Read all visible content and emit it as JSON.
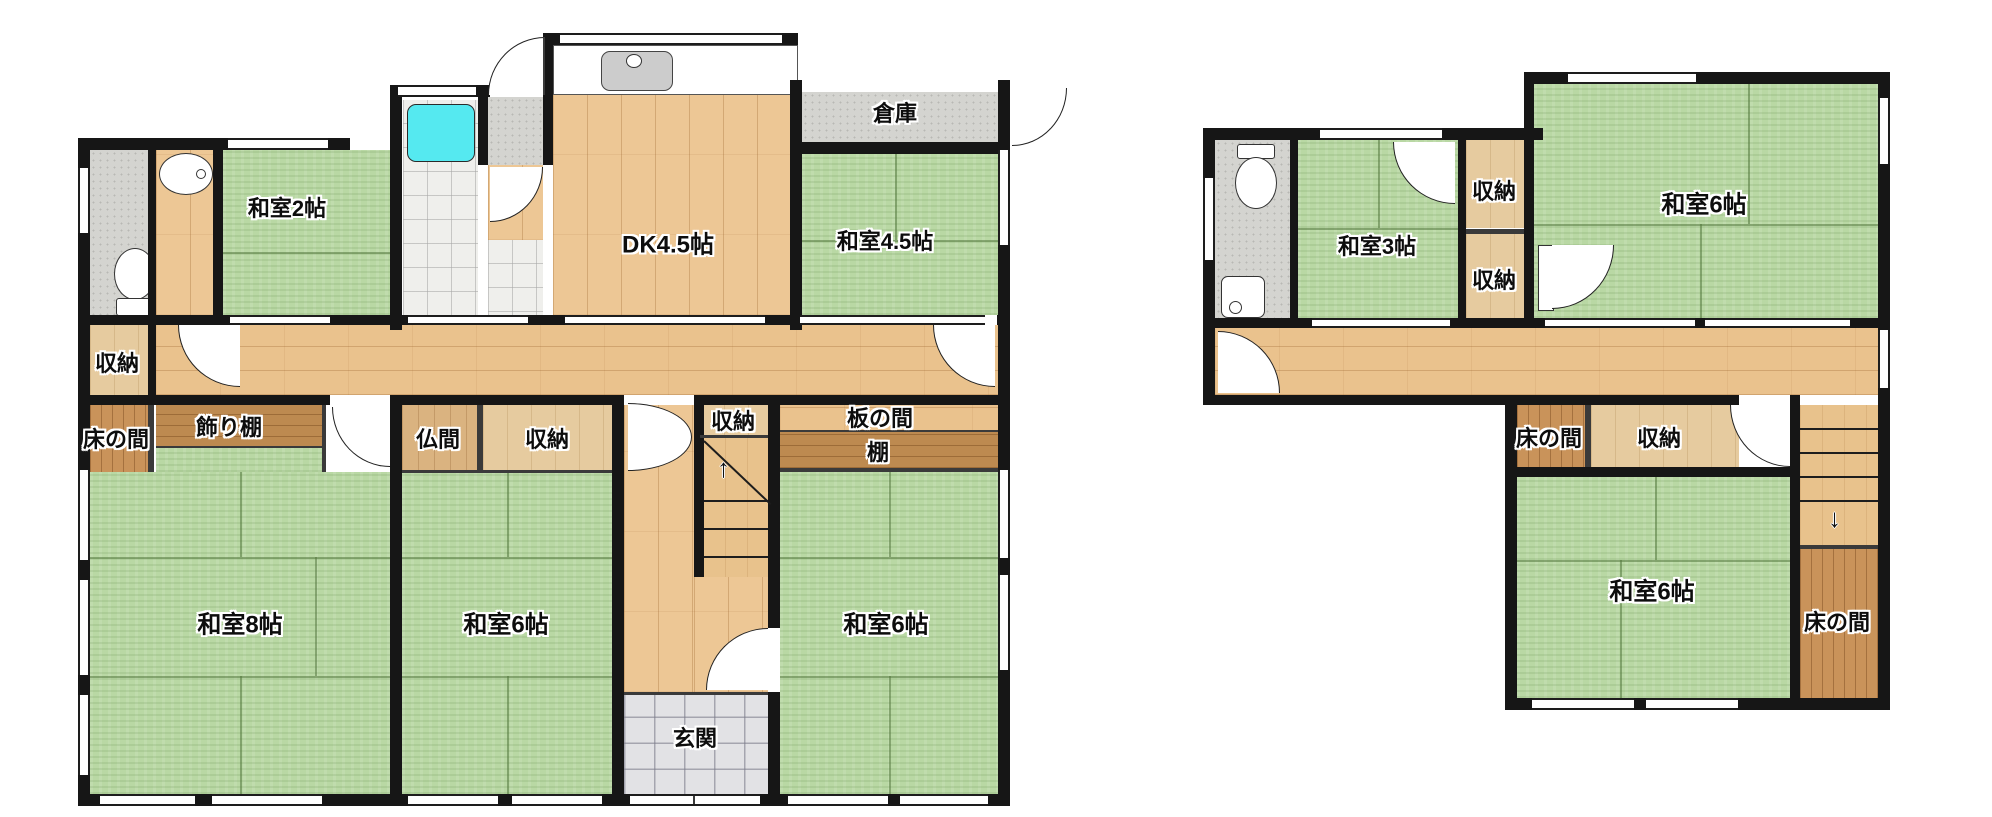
{
  "f1": {
    "washitsu2": "和室2帖",
    "dk": "DK4.5帖",
    "souko": "倉庫",
    "washitsu45": "和室4.5帖",
    "shuno_left": "収納",
    "tokonoma": "床の間",
    "kazaridana": "飾り棚",
    "butsuma": "仏間",
    "shuno_center": "収納",
    "shuno_stairs": "収納",
    "itanoma": "板の間",
    "tana": "棚",
    "washitsu8": "和室8帖",
    "washitsu6_center": "和室6帖",
    "washitsu6_right": "和室6帖",
    "genkan": "玄関"
  },
  "f2": {
    "washitsu3": "和室3帖",
    "shuno_upper": "収納",
    "shuno_lower": "収納",
    "washitsu6_top": "和室6帖",
    "tokonoma_left": "床の間",
    "shuno": "収納",
    "washitsu6_bottom": "和室6帖",
    "tokonoma_right": "床の間"
  },
  "icons": {
    "stairs_up_arrow": "↑",
    "stairs_down_arrow": "↓"
  },
  "palette": {
    "tatami_green": "#b9d8a4",
    "flooring_wood": "#edc795",
    "alcove_dark_wood": "#c9935a",
    "storage_wood": "#e6cb9f",
    "tile_gray": "#d4d4d0",
    "bath_tile_white": "#efefec",
    "bathtub_cyan": "#55e9f0",
    "genkan_tile": "#e2e2e5",
    "wall_black": "#161616"
  }
}
